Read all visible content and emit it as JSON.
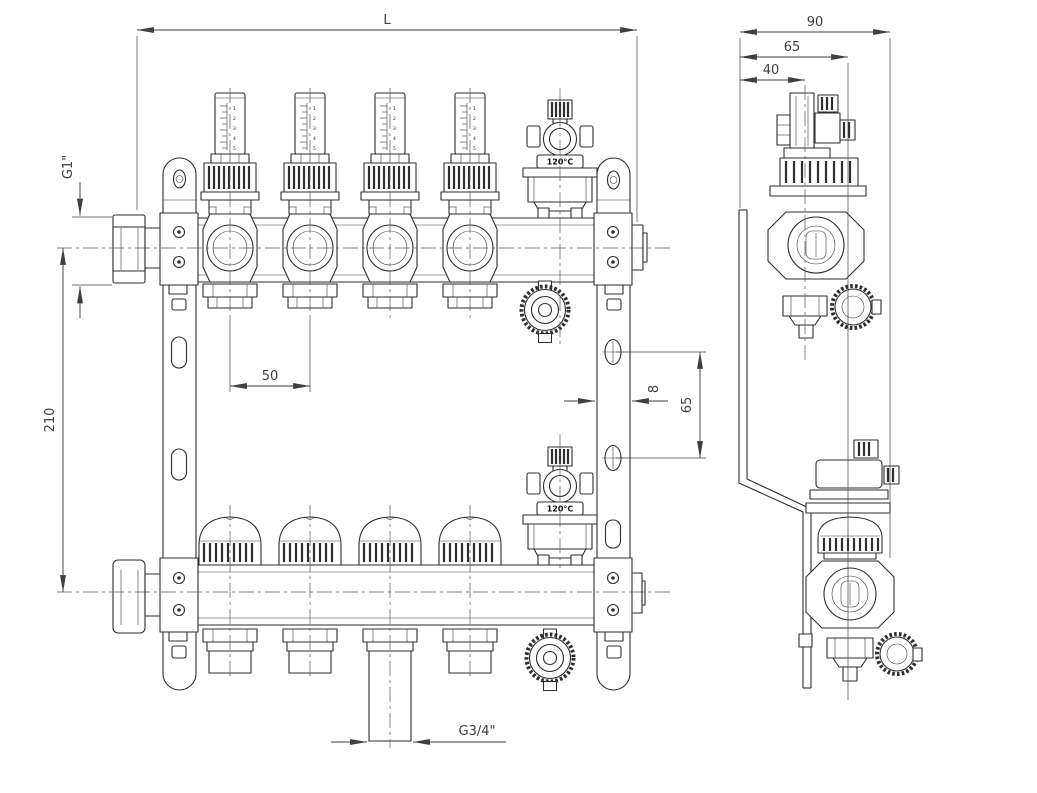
{
  "front_view": {
    "name": "manifold front view",
    "circuit_count": 4,
    "dims": {
      "overall_length": "L",
      "inlet_thread": "G1\"",
      "bar_center_distance": "210",
      "circuit_spacing": "50",
      "bracket_slot_width": "8",
      "bracket_hole_spacing": "65",
      "outlet_thread": "G3/4\""
    },
    "flowmeter_scale": [
      "1",
      "2",
      "3",
      "4",
      "5"
    ]
  },
  "side_view": {
    "name": "manifold side view",
    "dims": {
      "overall_depth": "90",
      "bottom_bar_depth": "65",
      "top_bar_depth": "40"
    }
  },
  "labels": {
    "air_vent_temp": "120°C"
  },
  "colors": {
    "line": "#2e2e2e",
    "dimension": "#3f3f3f",
    "background": "#ffffff"
  }
}
